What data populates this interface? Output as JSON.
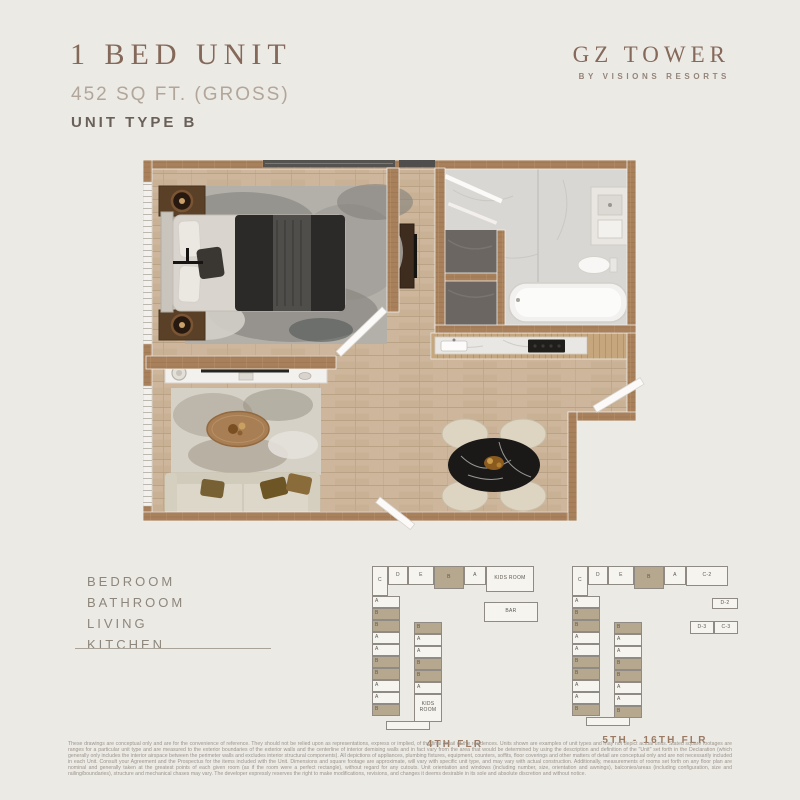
{
  "header": {
    "title": "1 BED UNIT",
    "sqft": "452 SQ FT. (GROSS)",
    "unit_type": "UNIT TYPE B"
  },
  "brand": {
    "name": "GZ TOWER",
    "tagline": "BY VISIONS RESORTS"
  },
  "legend": {
    "items": [
      "BEDROOM",
      "BATHROOM",
      "LIVING",
      "KITCHEN"
    ]
  },
  "colors": {
    "background": "#eceae5",
    "accent_brown": "#85695a",
    "wall_wood": "#a8805b",
    "floor_wood": "#cdb69b",
    "highlighted_unit": "#b5a88f"
  },
  "keyplans": [
    {
      "caption": "4TH FLR",
      "top_row": [
        {
          "label": "C",
          "w": 16,
          "h": 30
        },
        {
          "label": "D",
          "w": 20,
          "h": 19
        },
        {
          "label": "E",
          "w": 26,
          "h": 19
        },
        {
          "label": "B",
          "w": 30,
          "h": 23,
          "shaded": true
        },
        {
          "label": "A",
          "w": 22,
          "h": 19
        },
        {
          "label": "KIDS ROOM",
          "w": 48,
          "h": 26
        }
      ],
      "side_rows": [
        [
          {
            "label": "BAR",
            "w": 54,
            "h": 20,
            "mt": 6
          }
        ]
      ],
      "left_col": [
        "A",
        "B",
        "B",
        "A",
        "A",
        "B",
        "B",
        "A",
        "A",
        "B"
      ],
      "right_col": [
        "B",
        "A",
        "A",
        "B",
        "B",
        "A",
        "KIDS ROOM"
      ],
      "right_col_offset": 26
    },
    {
      "caption": "5TH - 16TH FLR",
      "top_row": [
        {
          "label": "C",
          "w": 16,
          "h": 30
        },
        {
          "label": "D",
          "w": 20,
          "h": 19
        },
        {
          "label": "E",
          "w": 26,
          "h": 19
        },
        {
          "label": "B",
          "w": 30,
          "h": 23,
          "shaded": true
        },
        {
          "label": "A",
          "w": 22,
          "h": 19
        },
        {
          "label": "C-2",
          "w": 42,
          "h": 20
        }
      ],
      "side_rows": [
        [
          {
            "label": "D-2",
            "w": 26,
            "h": 11,
            "mt": 2
          }
        ],
        [
          {
            "label": "D-3",
            "w": 24,
            "h": 13,
            "mt": 12
          },
          {
            "label": "C-3",
            "w": 24,
            "h": 13,
            "mt": 12
          }
        ]
      ],
      "left_col": [
        "A",
        "B",
        "B",
        "A",
        "A",
        "B",
        "B",
        "A",
        "A",
        "B"
      ],
      "right_col": [
        "B",
        "A",
        "A",
        "B",
        "B",
        "A",
        "A",
        "B"
      ],
      "right_col_offset": 26
    }
  ],
  "disclaimer": {
    "text": "These drawings are conceptual only and are for the convenience of reference.  They should not be relied upon as representations, express or implied, of the final detail of the residences.  Units shown are examples of unit types and may not depict actual units.  Stated square footages are ranges for a particular unit type and are measured to the exterior boundaries of the exterior walls and the centerline of interior demising walls and in fact vary from the area that would be determined by using the description and definition of the \"Unit\" set forth in the Declaration (which generally only includes the interior airspace between the perimeter walls and excludes interior structural components).  All depictions of appliances, plumbing fixtures, equipment, counters, soffits, floor coverings and other matters of detail are conceptual only and are not necessarily included in each Unit.  Consult your Agreement and the Prospectus for the items included with the Unit.  Dimensions and square footage are approximate, will vary with specific unit type, and may vary with actual construction.  Additionally, measurements of rooms set forth on any floor plan are nominal and generally taken at the greatest points of each given room (as if the room were a perfect rectangle), without regard for any cutouts.  Unit orientation and windows (including number, size, orientation and awnings), balconies/areas (including configuration, size and railing/boundaries), structure and mechanical chases may vary.  The developer expressly reserves the right to make modifications, revisions, and changes it deems desirable in its sole and absolute discretion and without notice."
  }
}
